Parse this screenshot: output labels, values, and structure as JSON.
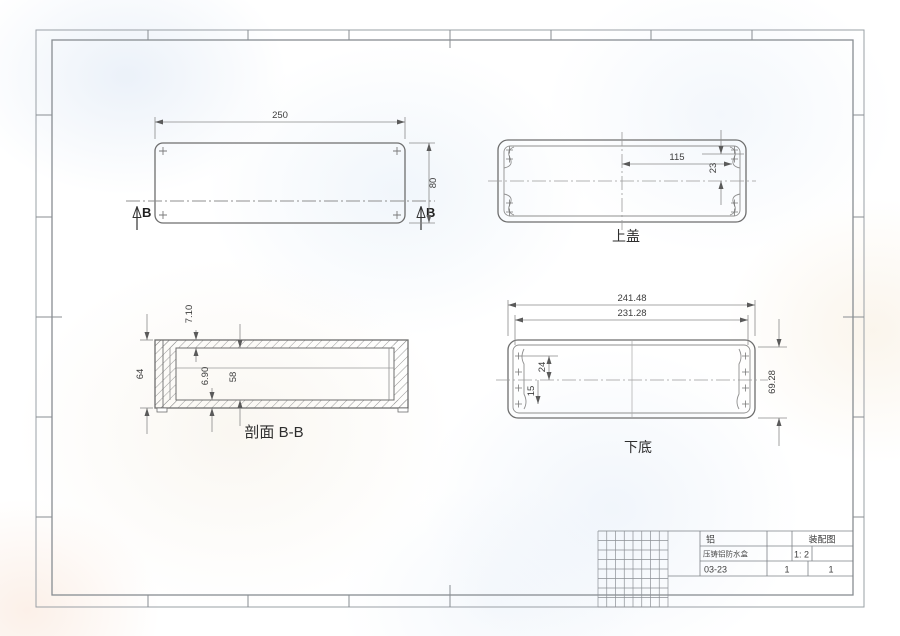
{
  "drawing": {
    "views": {
      "top_plan": {
        "dim_width": "250",
        "dim_height": "80",
        "section_label_left": "B",
        "section_label_right": "B"
      },
      "top_cover": {
        "label": "上盖",
        "dim_hole_x": "115",
        "dim_hole_y": "23"
      },
      "section_bb": {
        "label": "剖面 B-B",
        "dim_top_wall": "7.10",
        "dim_bottom_wall": "6.90",
        "dim_inner_height": "58",
        "dim_outer_height": "64"
      },
      "bottom_base": {
        "label": "下底",
        "dim_outer_width": "241.48",
        "dim_inner_width": "231.28",
        "dim_height": "69.28",
        "dim_upper_hole": "24",
        "dim_lower_hole": "15"
      }
    },
    "title_block": {
      "material": "铝",
      "doc_type": "装配图",
      "part_name": "压铸铝防水盒",
      "scale": "1: 2",
      "drawing_number": "03-23",
      "quantity": "1",
      "sheet_number": "1"
    },
    "colors": {
      "object_line": "#6e6e6e",
      "dim_line": "#8a8a8a",
      "frame_line": "#8e9297",
      "text": "#3d3d3d"
    }
  }
}
